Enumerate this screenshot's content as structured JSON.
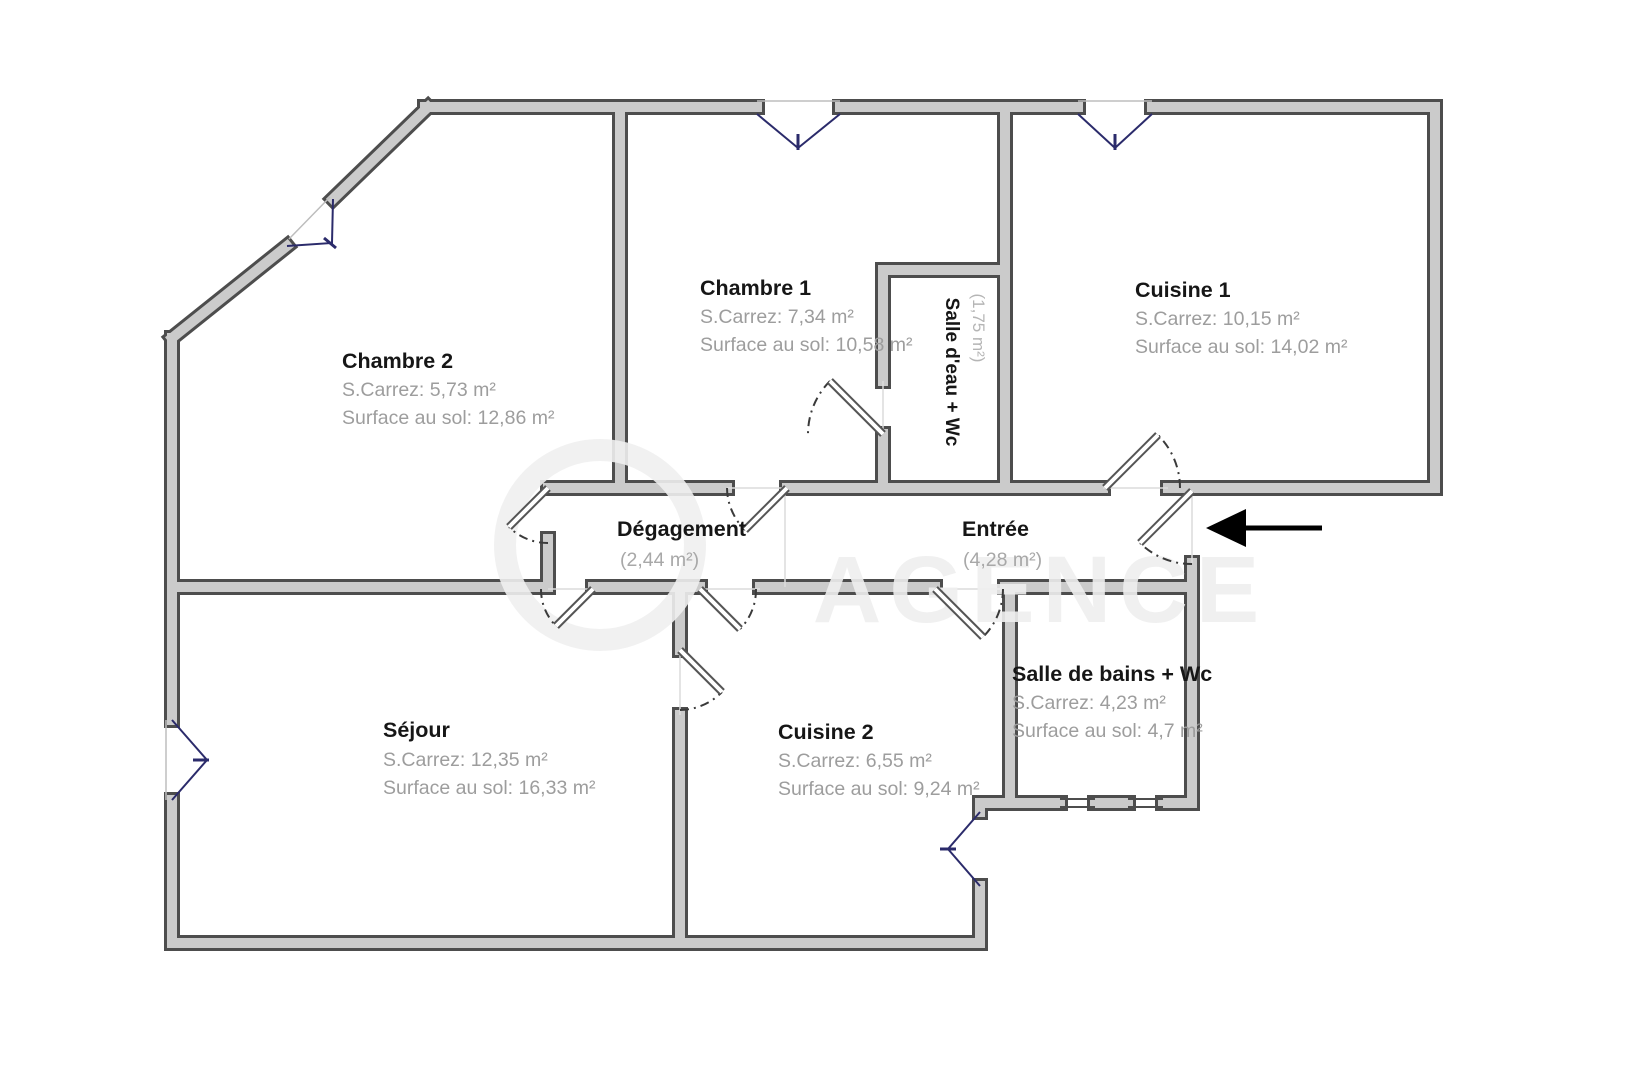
{
  "plan": {
    "type": "floor-plan",
    "language": "fr",
    "rooms": [
      {
        "id": "chambre2",
        "title": "Chambre 2",
        "carrez": "S.Carrez: 5,73 m²",
        "floor": "Surface au sol: 12,86 m²"
      },
      {
        "id": "chambre1",
        "title": "Chambre 1",
        "carrez": "S.Carrez: 7,34 m²",
        "floor": "Surface au sol: 10,58 m²"
      },
      {
        "id": "cuisine1",
        "title": "Cuisine 1",
        "carrez": "S.Carrez: 10,15 m²",
        "floor": "Surface au sol: 14,02 m²"
      },
      {
        "id": "salle-deau",
        "title": "Salle d'eau + Wc",
        "area": "(1,75 m²)"
      },
      {
        "id": "degagement",
        "title": "Dégagement",
        "area": "(2,44 m²)"
      },
      {
        "id": "entree",
        "title": "Entrée",
        "area": "(4,28 m²)"
      },
      {
        "id": "sejour",
        "title": "Séjour",
        "carrez": "S.Carrez: 12,35 m²",
        "floor": "Surface au sol: 16,33 m²"
      },
      {
        "id": "cuisine2",
        "title": "Cuisine 2",
        "carrez": "S.Carrez: 6,55 m²",
        "floor": "Surface au sol: 9,24 m²"
      },
      {
        "id": "salle-de-bains",
        "title": "Salle de bains + Wc",
        "carrez": "S.Carrez: 4,23 m²",
        "floor": "Surface au sol: 4,7 m²"
      }
    ],
    "watermark": "AGENCE",
    "entrance_arrow": "left",
    "colors": {
      "wall_fill": "#cbcbcb",
      "wall_edge": "#4d4d4d",
      "window": "#2b2b6b",
      "door": "#555555",
      "arrow": "#000000",
      "title_text": "#161616",
      "sub_text": "#9d9d9d",
      "background": "#ffffff"
    }
  }
}
